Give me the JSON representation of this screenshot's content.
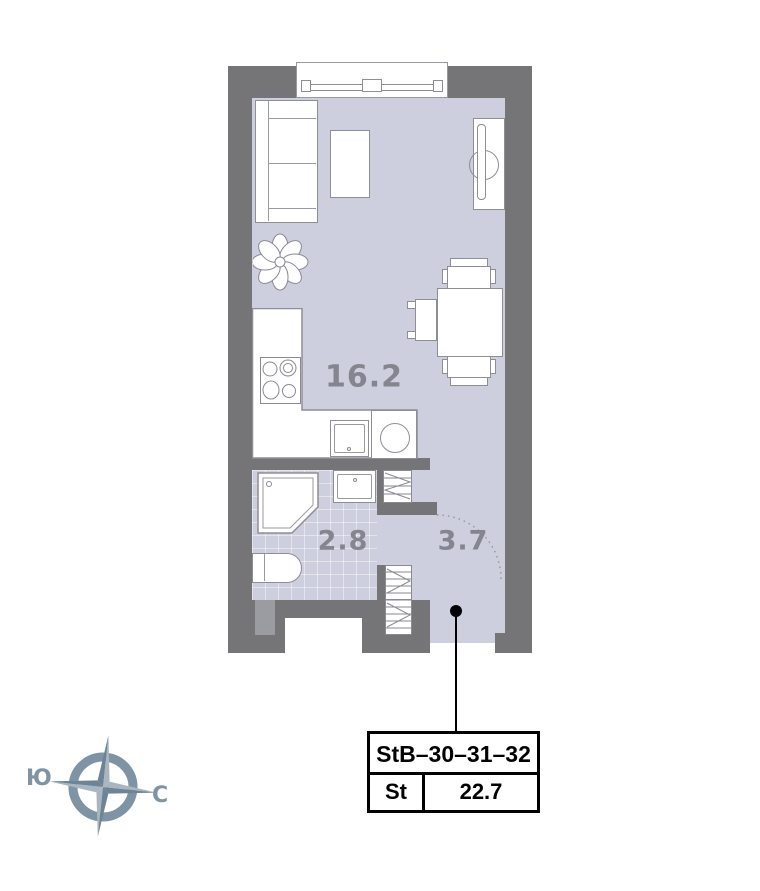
{
  "plan": {
    "rooms": [
      {
        "id": "living-kitchen",
        "area": "16.2"
      },
      {
        "id": "bathroom",
        "area": "2.8"
      },
      {
        "id": "hall",
        "area": "3.7"
      }
    ],
    "unit_card": {
      "code": "StB–30–31–32",
      "type": "St",
      "total_area": "22.7"
    },
    "compass": {
      "south": "Ю",
      "north": "С"
    },
    "colors": {
      "wall": "#757578",
      "floor": "#cdcede",
      "room_label": "#84858e",
      "compass": "#7e93a3",
      "card_border": "#000000"
    }
  }
}
